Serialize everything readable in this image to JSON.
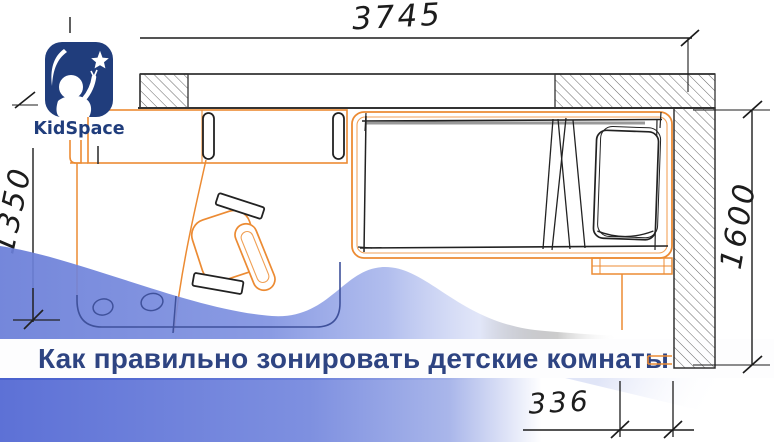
{
  "brand": {
    "name": "KidSpace"
  },
  "headline": {
    "text": "Как правильно зонировать детские комнаты"
  },
  "floor_plan": {
    "dimensions": {
      "top_mm": "3745",
      "left_mm": "1350",
      "right_mm": "1600",
      "bottom_mm": "336"
    },
    "furniture": [
      "bed",
      "pillow",
      "desk",
      "desk-chair",
      "rug",
      "door-swing",
      "shelf"
    ]
  },
  "colors": {
    "logo_navy": "#203d7c",
    "headline_text": "#2e4482",
    "furniture_orange": "#ec8b33",
    "wave_blue_left": "#6a7ed8",
    "band_blue": "#5d71d6",
    "ink": "#1c1c1c"
  }
}
